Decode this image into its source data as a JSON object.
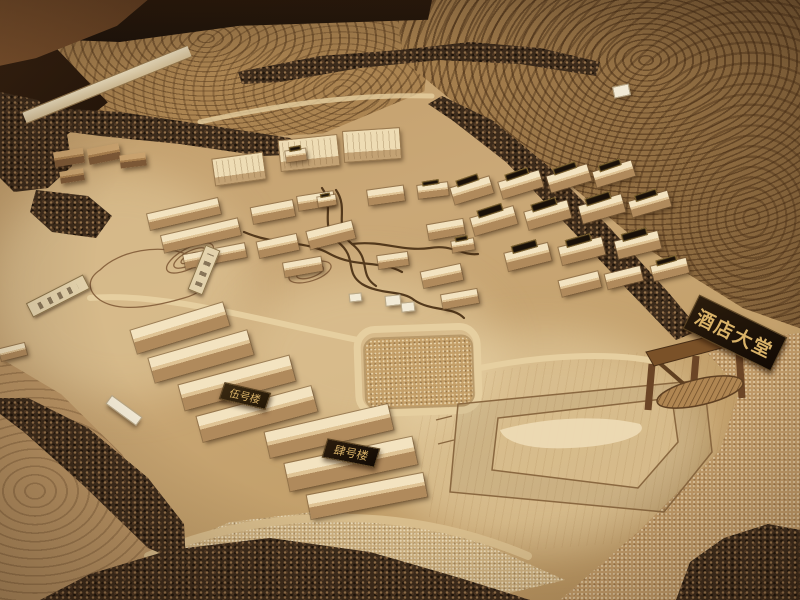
{
  "scene": {
    "signs": {
      "hotel_lobby": "酒店大堂",
      "building_5": "伍号楼",
      "building_4": "肆号楼"
    },
    "colors": {
      "ground_tan": "#c6a06c",
      "plywood_pad": "#e4cb9b",
      "terrace_base": "#ab8451",
      "contour_line": "#52361a",
      "tree_band": "#3c2b1b",
      "sign_background": "#241708",
      "sign_gold_text": "#d9b268",
      "table_surface": "#221409"
    }
  }
}
